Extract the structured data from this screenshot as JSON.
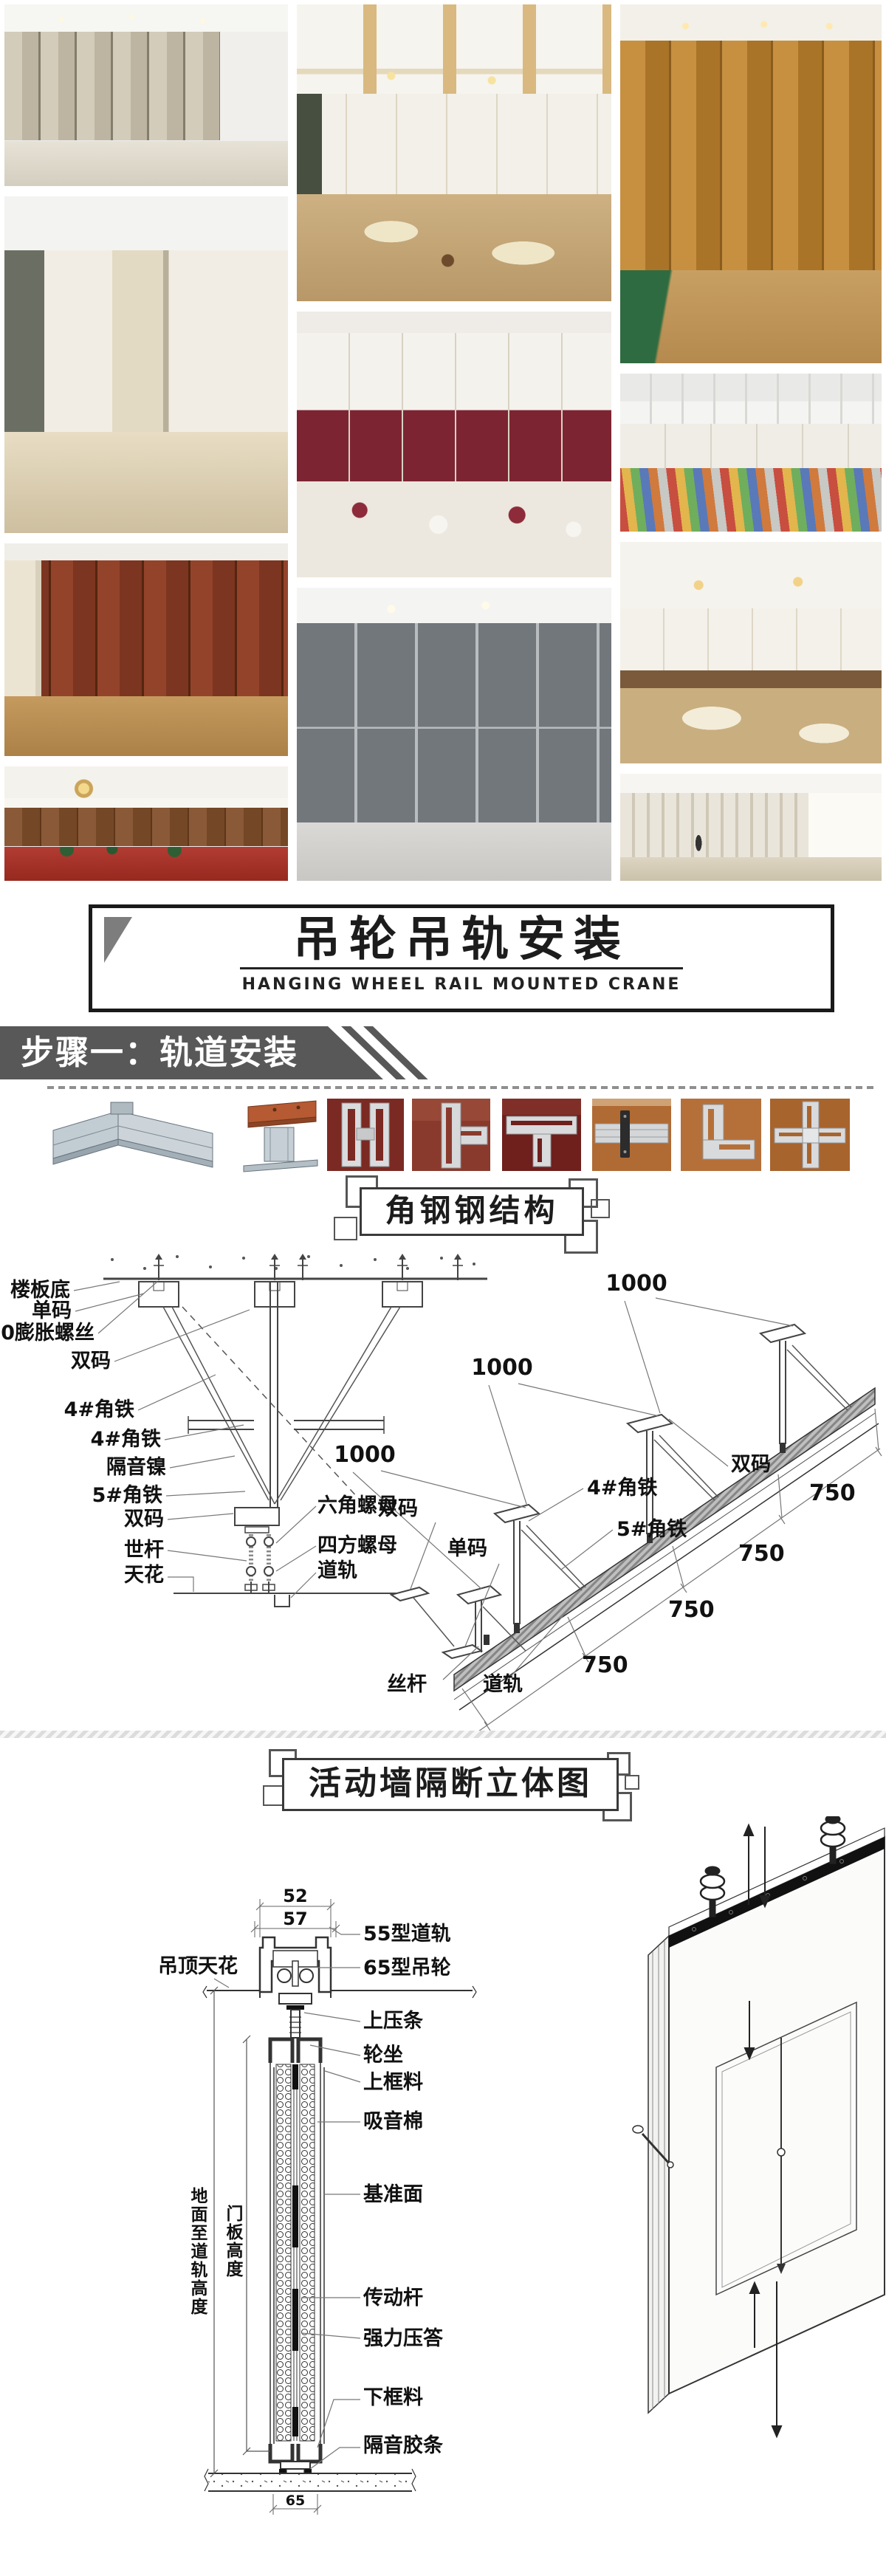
{
  "banner": {
    "title_zh": "吊轮吊轨安装",
    "title_en": "HANGING WHEEL RAIL MOUNTED CRANE"
  },
  "step": {
    "label": "步骤一：轨道安装"
  },
  "angle_section": {
    "title": "角钢钢结构",
    "elev_labels": [
      "楼板底",
      "单码",
      "10膨胀螺丝",
      "双码",
      "4#角铁",
      "4#角铁",
      "隔音镍",
      "5#角铁",
      "双码",
      "世杆",
      "天花"
    ],
    "nut_labels": [
      "六角螺母",
      "四方螺母",
      "道轨"
    ],
    "iso_dims_1000": [
      "1000",
      "1000",
      "1000"
    ],
    "iso_dims_750": [
      "750",
      "750",
      "750",
      "750"
    ],
    "iso_labels": {
      "shuangma_a": "双码",
      "shuangma_b": "双码",
      "danma": "单码",
      "angle4": "4#角铁",
      "angle5": "5#角铁",
      "sigan": "丝杆",
      "daogui": "道轨"
    }
  },
  "partition_section": {
    "title": "活动墙隔断立体图",
    "dims": {
      "w52": "52",
      "w57": "57",
      "w65": "65"
    },
    "left_labels": {
      "ceiling": "吊顶天花",
      "height_to_rail": "地面至道轨高度",
      "door_height": "门板高度"
    },
    "right_labels": [
      "55型道轨",
      "65型吊轮",
      "上压条",
      "轮坐",
      "上框料",
      "吸音棉",
      "基准面",
      "传动杆",
      "强力压答",
      "下框料",
      "隔音胶条"
    ]
  }
}
